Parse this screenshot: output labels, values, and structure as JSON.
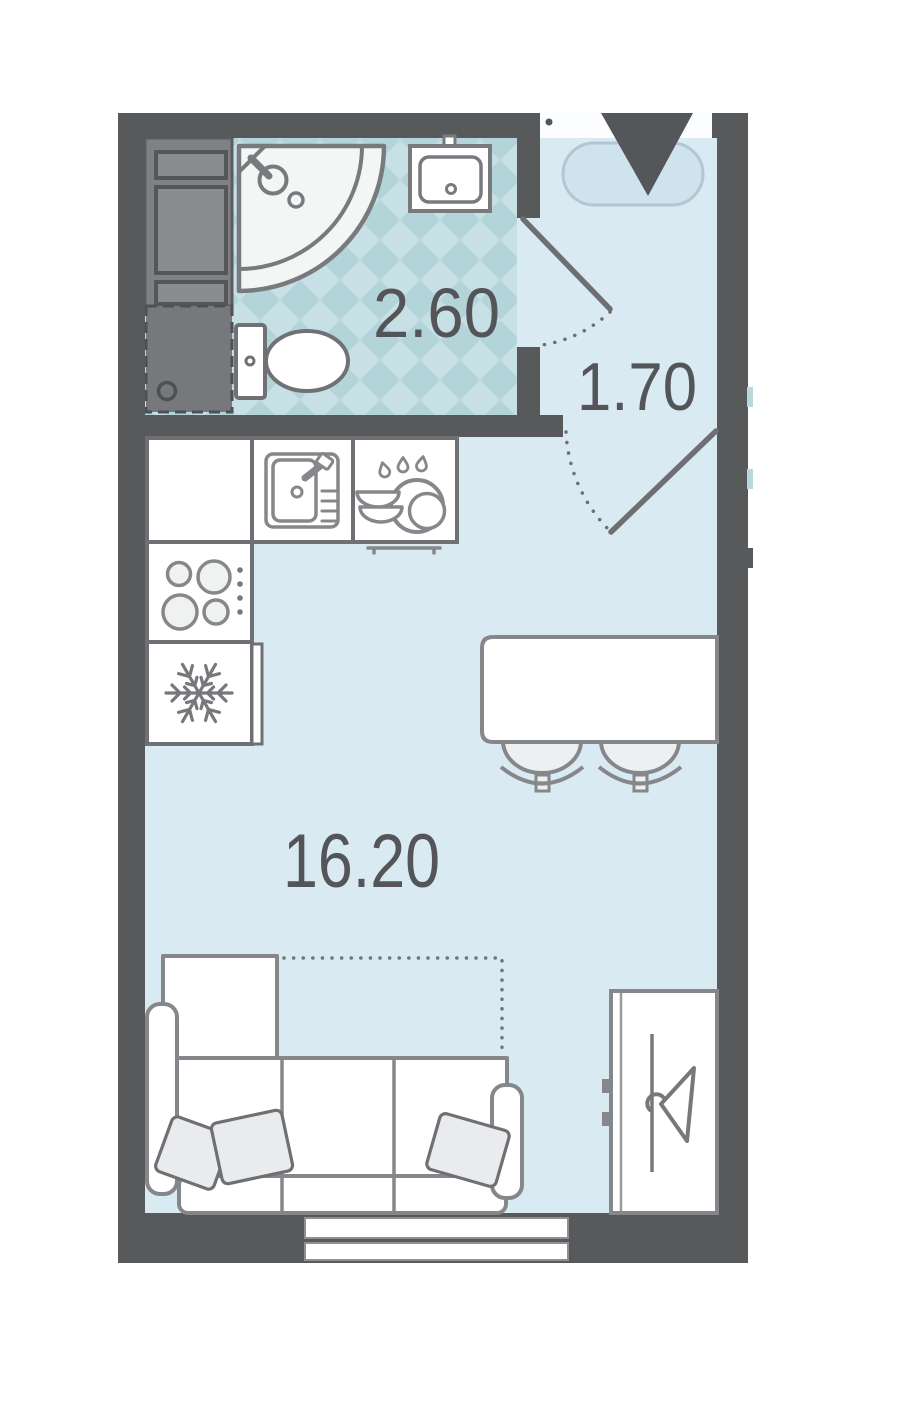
{
  "plan": {
    "title": "Studio apartment floor plan",
    "rooms": {
      "bathroom": {
        "name": "bathroom",
        "area": "2.60"
      },
      "hallway": {
        "name": "entrance hall",
        "area": "1.70"
      },
      "living": {
        "name": "living room with kitchen",
        "area": "16.20"
      }
    },
    "colors": {
      "wall": "#58595b",
      "floor": "#d9eaf3",
      "bathroom_tile_light": "#c6e0e5",
      "bathroom_tile_dark": "#b3d5da",
      "fixture_stroke": "#85878a",
      "label_text": "#545559",
      "entry_mat_fill": "#cee3ed",
      "entry_mat_stroke": "#b3c7d2",
      "shaft_fill": "#7f8184",
      "furniture_fill": "#ffffff"
    },
    "icons": {
      "entrance": "entrance-arrow-icon",
      "fridge": "snowflake-icon",
      "wardrobe": "hanger-icon",
      "kitchen_sink": "sink-icon",
      "dish_rack": "dishes-icon",
      "stove": "burners-icon",
      "bathroom_sink": "washbasin-icon",
      "shower": "shower-icon",
      "toilet": "toilet-icon",
      "washing_machine": "washing-machine-icon"
    }
  }
}
